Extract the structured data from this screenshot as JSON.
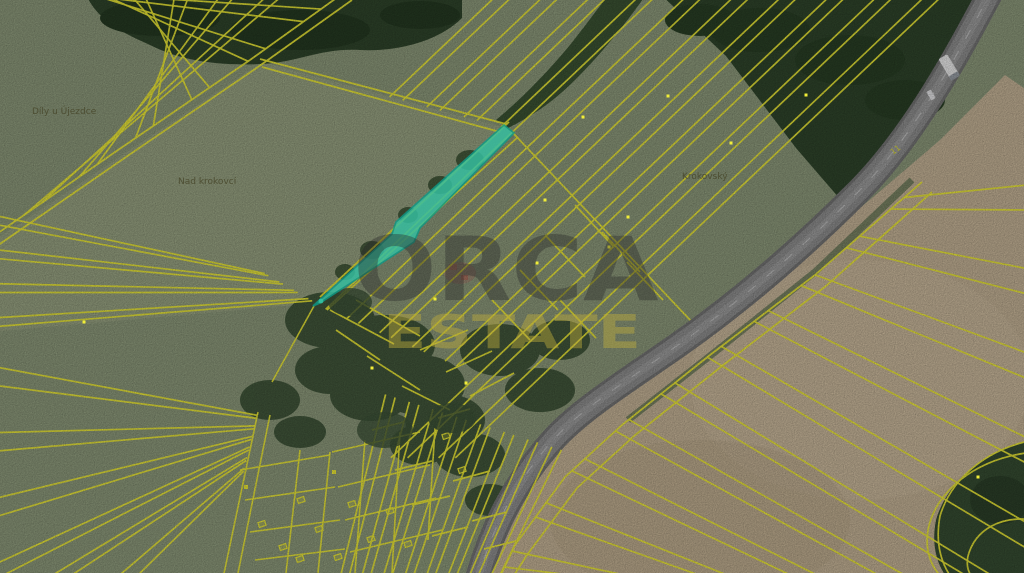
{
  "map": {
    "watermark": {
      "primary": "ORCA",
      "secondary": "ESTATE"
    },
    "place_labels": [
      {
        "text": "Díly u Újezdce"
      },
      {
        "text": "Nad krokovcí"
      },
      {
        "text": "Krokovský"
      }
    ],
    "road_label": "11",
    "colors": {
      "parcel_line": "#f1ee38",
      "highlight_fill": "#35c1a2",
      "highlight_stroke": "#0d9a87",
      "field_green": "#8f9c7d",
      "field_green_light": "#9aa584",
      "field_tan": "#c8b699",
      "forest": "#30462c",
      "scrub": "#3f5539",
      "road": "#919191",
      "road_casing": "#767676",
      "label_text": "#4a4a2e",
      "watermark_primary": "rgba(40,40,40,0.38)",
      "watermark_secondary": "rgba(190,172,60,0.45)"
    }
  }
}
